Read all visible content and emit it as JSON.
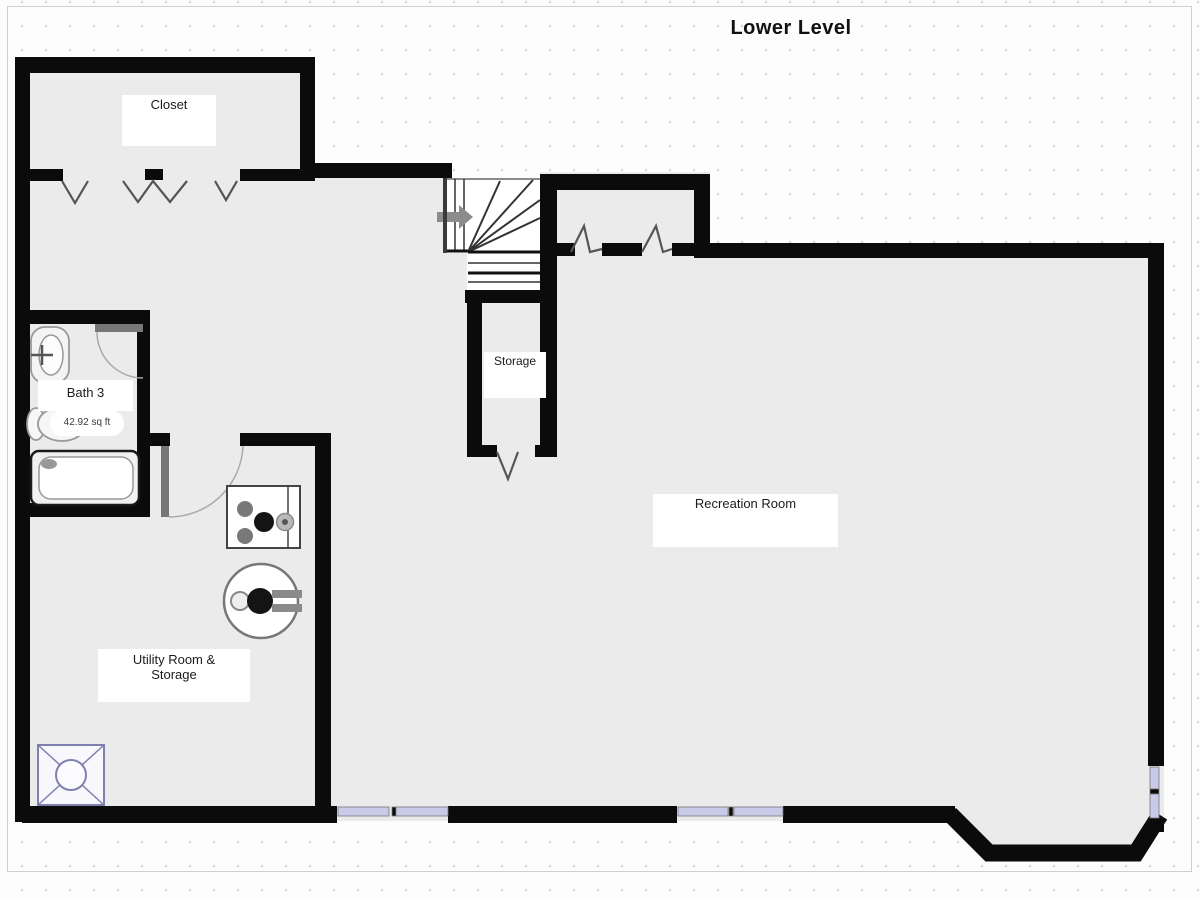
{
  "title": "Lower Level",
  "rooms": {
    "closet": "Closet",
    "bath": "Bath 3",
    "bath_area": "42.92 sq ft",
    "storage": "Storage",
    "recreation": "Recreation Room",
    "utility_line1": "Utility Room &",
    "utility_line2": "Storage"
  },
  "icons": {
    "staircase": "stairs-icon",
    "stair_arrow": "direction-arrow-icon",
    "doors": [
      "hinged-door-icon",
      "bifold-door-icon"
    ],
    "fixtures": [
      "sink-icon",
      "toilet-icon",
      "bathtub-icon",
      "furnace-icon",
      "water-heater-icon",
      "floor-drain-icon"
    ],
    "windows": "window-icon"
  },
  "colors": {
    "wall": "#0b0b0b",
    "floor": "#ebebeb",
    "stair_fill": "#ffffff",
    "window": "#c9c9e8",
    "drain_accent": "#8080b0",
    "door_leaf": "#777777"
  }
}
